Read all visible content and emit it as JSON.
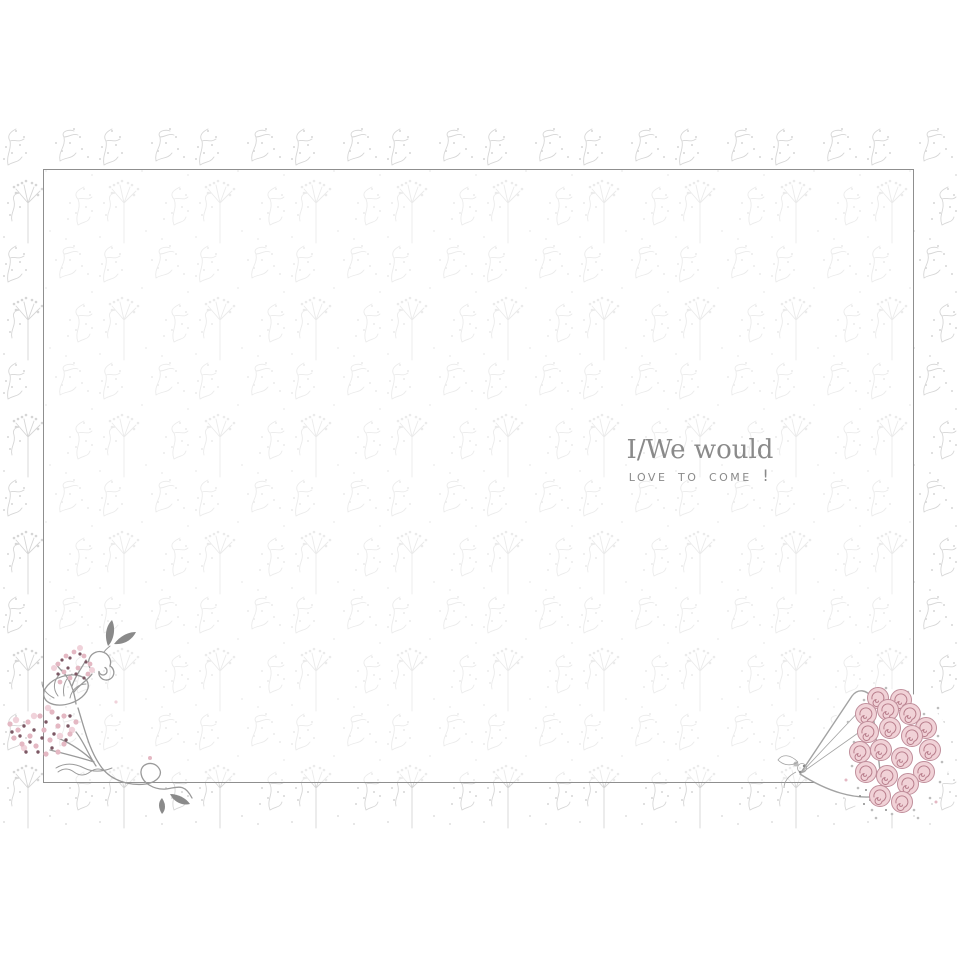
{
  "message": {
    "line1": "I/We would",
    "line2": "love to come !"
  },
  "decorations": {
    "corner_flourish": "floral-flourish-with-pink-berries",
    "bouquet": "wrapped-pink-rose-bouquet"
  },
  "colors": {
    "page_bg": "#ffffff",
    "pattern": "#d6d6d6",
    "frame": "#8f8f8f",
    "text": "#8a8a8a",
    "flourish_line": "#9a9a9a",
    "leaf_dark": "#8a8a8a",
    "berry_pink": "#e4b8c3",
    "berry_light": "#f0d2da",
    "berry_dark": "#7c5864",
    "rose_fill": "#f1d2d7",
    "rose_stroke": "#c08e9b",
    "rose_swirl": "#b97f8d",
    "cone_stroke": "#a3a3a3",
    "foliage_speck": "#bdbdbd"
  }
}
